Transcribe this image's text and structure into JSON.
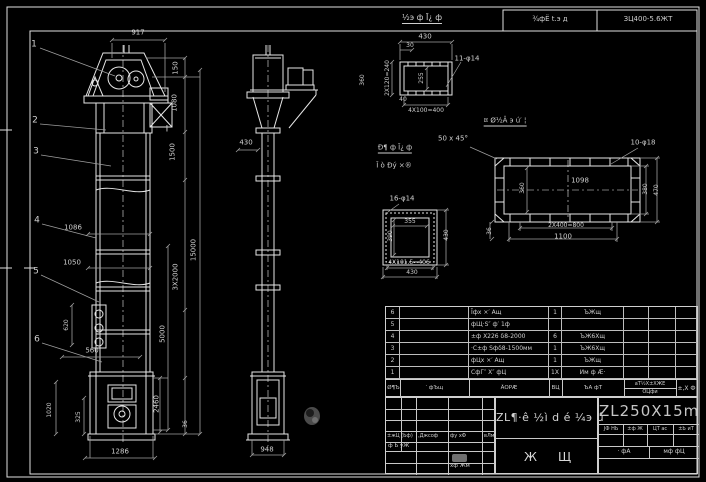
{
  "header": {
    "note": "¾фЁ t.э д",
    "spec": "ЗЦ400-5.6ЖΤ"
  },
  "colors": {
    "background": "#000000",
    "line": "#e0e0e0",
    "dim_line": "#9f9f9f",
    "text": "#cfcfcf"
  },
  "title_block": {
    "model": "ZL250X15m",
    "title": "ZL¶·ê ½ì d é ¼э ú",
    "stamp1": "Ж",
    "stamp2": "Щ",
    "sig": {
      "h1": "±жЦ (Ьф)",
      "h2": ",Джсоф",
      "h3": "фу хФ",
      "h4": "вЛм",
      "r2": "ф Ь уЖ",
      "r3": "хф Жм"
    },
    "right": {
      "c1": "ЈФ НЬ",
      "c2": "±ф Ж",
      "c3": "ЦΤ аc",
      "c4": "±Ь иТ",
      "b1": "· фА",
      "b2": "мф фЦ"
    }
  },
  "bom": {
    "header": {
      "c1": "Ø¶Ъ",
      "c2": "′ фЪщ",
      "c3": "ÃОРÆ",
      "c4": "ВЦ",
      "c5": "ЪА фТ",
      "c6a": "аТ½Х±ХЖЕ",
      "c6b": "ÓЦфи",
      "c7": "±,Х Ф"
    },
    "rows": [
      [
        "6",
        "",
        "Ĩфх ×′ Ащ",
        "1",
        "ЪЖщ",
        "",
        "",
        ""
      ],
      [
        "5",
        "",
        "фЩ·Ѕ″ ф′ 1ф",
        "",
        "",
        "",
        "",
        ""
      ],
      [
        "4",
        "",
        "±ф Х226 δ8-2000",
        "6",
        "ЪЖ6Хщ",
        "",
        "",
        ""
      ],
      [
        "3",
        "",
        "·С±ф Ѕфδ8-1500мм",
        "1",
        "ЪЖ6Хщ",
        "",
        "",
        ""
      ],
      [
        "2",
        "",
        "фЦх ×′ Ащ",
        "1",
        "ЪЖщ",
        "",
        "",
        ""
      ],
      [
        "1",
        "",
        "СфГ″ Х″ фЦ",
        "1Х",
        "Им ф Æ·",
        "",
        "",
        ""
      ]
    ]
  },
  "labels": [
    {
      "n": "detail-a-title",
      "t": "½э ф Ī¿ ф",
      "x": 422,
      "y": 19,
      "s": 8,
      "u": 1
    },
    {
      "n": "dim-917",
      "t": "917",
      "x": 138,
      "y": 33
    },
    {
      "n": "dim-150",
      "t": "150",
      "x": 176,
      "y": 68,
      "r": -90
    },
    {
      "n": "dim-1080",
      "t": "1080",
      "x": 175,
      "y": 103,
      "r": -90
    },
    {
      "n": "dim-1500",
      "t": "1500",
      "x": 173,
      "y": 152,
      "r": -90
    },
    {
      "n": "dim-3x2000",
      "t": "3Х2000",
      "x": 176,
      "y": 277,
      "r": -90
    },
    {
      "n": "dim-15000",
      "t": "15000",
      "x": 194,
      "y": 250,
      "r": -90
    },
    {
      "n": "dim-5000",
      "t": "5000",
      "x": 163,
      "y": 334,
      "r": -90
    },
    {
      "n": "dim-2460",
      "t": "2460",
      "x": 157,
      "y": 404,
      "r": -90
    },
    {
      "n": "dim-36-front",
      "t": "36",
      "x": 186,
      "y": 424,
      "r": -90,
      "s": 6
    },
    {
      "n": "dim-1086",
      "t": "1086",
      "x": 73,
      "y": 228
    },
    {
      "n": "dim-1050",
      "t": "1050",
      "x": 72,
      "y": 263
    },
    {
      "n": "dim-620",
      "t": "620",
      "x": 67,
      "y": 325,
      "r": -90,
      "s": 6
    },
    {
      "n": "dim-560",
      "t": "560",
      "x": 92,
      "y": 351
    },
    {
      "n": "dim-1020",
      "t": "1020",
      "x": 50,
      "y": 410,
      "r": -90,
      "s": 6
    },
    {
      "n": "dim-325",
      "t": "325",
      "x": 79,
      "y": 417,
      "r": -90,
      "s": 6
    },
    {
      "n": "dim-1286",
      "t": "1286",
      "x": 120,
      "y": 452
    },
    {
      "n": "balloon-1",
      "t": "1",
      "x": 34,
      "y": 45,
      "s": 9
    },
    {
      "n": "balloon-2",
      "t": "2",
      "x": 35,
      "y": 121,
      "s": 9
    },
    {
      "n": "balloon-3",
      "t": "3",
      "x": 36,
      "y": 152,
      "s": 9
    },
    {
      "n": "balloon-4",
      "t": "4",
      "x": 37,
      "y": 221,
      "s": 9
    },
    {
      "n": "balloon-5",
      "t": "5",
      "x": 36,
      "y": 272,
      "s": 9
    },
    {
      "n": "balloon-6",
      "t": "6",
      "x": 37,
      "y": 340,
      "s": 9
    },
    {
      "n": "section-mark",
      "t": "I",
      "x": 167,
      "y": 130,
      "s": 9
    },
    {
      "n": "dim-430-side",
      "t": "430",
      "x": 246,
      "y": 143
    },
    {
      "n": "dim-948",
      "t": "948",
      "x": 267,
      "y": 450
    },
    {
      "n": "dim-2x120",
      "t": "2Х120=240",
      "x": 388,
      "y": 78,
      "r": -90,
      "s": 6
    },
    {
      "n": "dim-360-side",
      "t": "360",
      "x": 363,
      "y": 80,
      "r": -90,
      "s": 6
    },
    {
      "n": "dim-430-det",
      "t": "430",
      "x": 425,
      "y": 37
    },
    {
      "n": "dim-30",
      "t": "30",
      "x": 410,
      "y": 46,
      "s": 6
    },
    {
      "n": "dim-255",
      "t": "255",
      "x": 422,
      "y": 78,
      "r": -90,
      "s": 6
    },
    {
      "n": "dim-40",
      "t": "40",
      "x": 403,
      "y": 100,
      "s": 6
    },
    {
      "n": "dim-4x100",
      "t": "4Х100=400",
      "x": 426,
      "y": 111,
      "s": 6
    },
    {
      "n": "dim-11holes",
      "t": "11-φ14",
      "x": 467,
      "y": 59
    },
    {
      "n": "note-chamfer",
      "t": "50 x 45°",
      "x": 453,
      "y": 139
    },
    {
      "n": "detail-b-title-1",
      "t": "Đ¶ ф Ī¿ ф",
      "x": 395,
      "y": 149,
      "u": 1
    },
    {
      "n": "detail-b-title-2",
      "t": "Ĩ ò Đý ×®",
      "x": 394,
      "y": 166
    },
    {
      "n": "detail-c-title",
      "t": "¤ Ø½Â э ú′ ¦",
      "x": 505,
      "y": 122,
      "u": 1
    },
    {
      "n": "dim-10holes",
      "t": "10-φ18",
      "x": 643,
      "y": 143
    },
    {
      "n": "dim-1098",
      "t": "1098",
      "x": 580,
      "y": 181
    },
    {
      "n": "dim-360-flange",
      "t": "360",
      "x": 523,
      "y": 188,
      "r": -90,
      "s": 6
    },
    {
      "n": "dim-380",
      "t": "380",
      "x": 646,
      "y": 189,
      "r": -90,
      "s": 6
    },
    {
      "n": "dim-470",
      "t": "470",
      "x": 657,
      "y": 190,
      "r": -90,
      "s": 6
    },
    {
      "n": "dim-2x400",
      "t": "2Х400=800",
      "x": 566,
      "y": 226,
      "s": 6
    },
    {
      "n": "dim-1100",
      "t": "1100",
      "x": 563,
      "y": 237
    },
    {
      "n": "dim-36-flange",
      "t": "36",
      "x": 490,
      "y": 231,
      "r": -90,
      "s": 6
    },
    {
      "n": "dim-16holes",
      "t": "16-φ14",
      "x": 402,
      "y": 199
    },
    {
      "n": "dim-355",
      "t": "355",
      "x": 410,
      "y": 222,
      "s": 6
    },
    {
      "n": "dim-390",
      "t": "390",
      "x": 391,
      "y": 236,
      "r": -90,
      "s": 6
    },
    {
      "n": "dim-430-sq-r",
      "t": "430",
      "x": 447,
      "y": 235,
      "r": -90,
      "s": 6
    },
    {
      "n": "dim-4x1015",
      "t": "4Х101.5=406",
      "x": 409,
      "y": 263,
      "s": 6
    },
    {
      "n": "dim-430-sq-b",
      "t": "430",
      "x": 412,
      "y": 273,
      "s": 6
    }
  ]
}
